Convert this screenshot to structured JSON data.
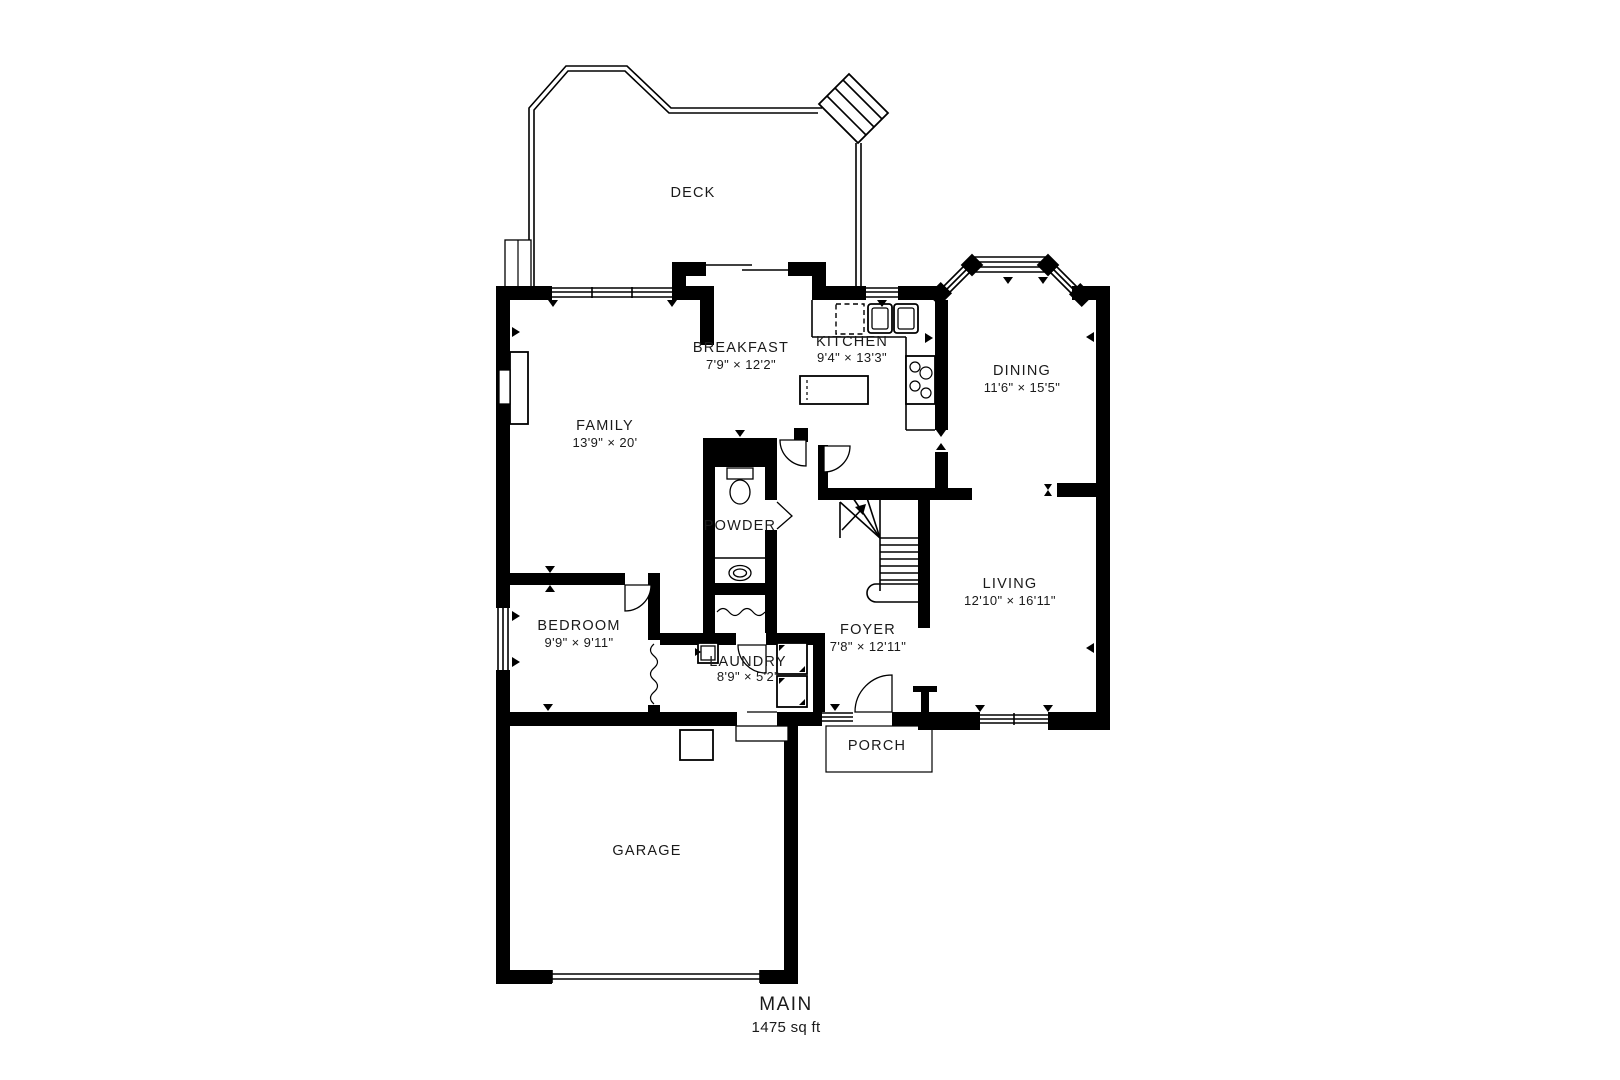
{
  "plan": {
    "title": "MAIN",
    "area": "1475 sq ft",
    "rooms": {
      "deck": {
        "name": "DECK",
        "dims": ""
      },
      "family": {
        "name": "FAMILY",
        "dims": "13'9\" × 20'"
      },
      "breakfast": {
        "name": "BREAKFAST",
        "dims": "7'9\" × 12'2\""
      },
      "kitchen": {
        "name": "KITCHEN",
        "dims": "9'4\" × 13'3\""
      },
      "dining": {
        "name": "DINING",
        "dims": "11'6\" × 15'5\""
      },
      "powder": {
        "name": "POWDER",
        "dims": ""
      },
      "living": {
        "name": "LIVING",
        "dims": "12'10\" × 16'11\""
      },
      "bedroom": {
        "name": "BEDROOM",
        "dims": "9'9\" × 9'11\""
      },
      "foyer": {
        "name": "FOYER",
        "dims": "7'8\" × 12'11\""
      },
      "laundry": {
        "name": "LAUNDRY",
        "dims": "8'9\" × 5'2\""
      },
      "porch": {
        "name": "PORCH",
        "dims": ""
      },
      "garage": {
        "name": "GARAGE",
        "dims": ""
      }
    },
    "colors": {
      "wall": "#000000",
      "background": "#ffffff",
      "text": "#1a1a1a"
    }
  }
}
